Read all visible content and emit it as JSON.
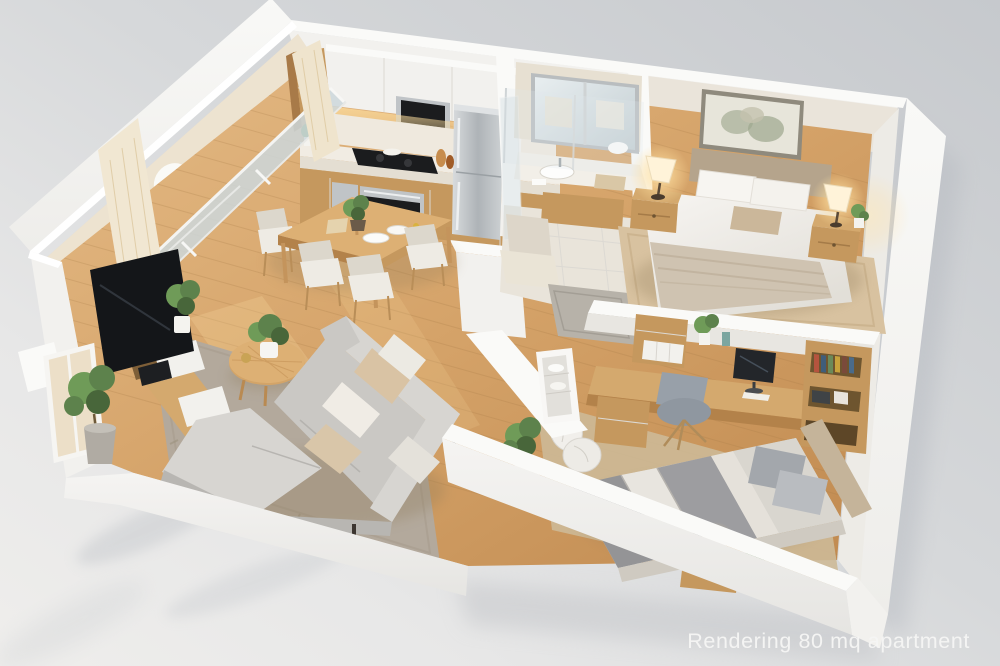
{
  "caption": "Rendering 80 mq apartment",
  "scene": {
    "type": "3D isometric cutaway rendering of an apartment",
    "area_label": "80 mq",
    "background_color": "#d3d5d8",
    "caption_color": "#f6f6f5",
    "rooms": [
      {
        "name": "balcony",
        "items": [
          "lounge chair",
          "potted plants",
          "sliding glass doors",
          "cream curtains"
        ]
      },
      {
        "name": "kitchen",
        "items": [
          "white upper cabinets",
          "built-in microwave",
          "oak base cabinets",
          "black cooktop",
          "built-in oven",
          "stainless steel refrigerator",
          "under-cabinet lighting",
          "tall oak cabinet"
        ]
      },
      {
        "name": "dining area",
        "items": [
          "oak dining table",
          "four cream chairs",
          "plant centerpiece",
          "white plates"
        ]
      },
      {
        "name": "living room",
        "items": [
          "gray L-shaped sectional sofa",
          "beige and white cushions",
          "round oak coffee table",
          "gray area rug",
          "flat-screen TV",
          "oak media console with white drawers",
          "floor plants",
          "window wall"
        ]
      },
      {
        "name": "bathroom",
        "items": [
          "vanity with sink",
          "large framed mirror",
          "glass shower partition",
          "beige tile floor",
          "wood vanity cabinet"
        ]
      },
      {
        "name": "hallway",
        "items": [
          "gray runner rug",
          "cream door mat",
          "shelf niche with towels"
        ]
      },
      {
        "name": "master bedroom",
        "items": [
          "double bed with white duvet",
          "beige throw blanket",
          "upholstered headboard",
          "framed wall art",
          "two oak nightstands",
          "two lit table lamps",
          "small plant",
          "beige rug"
        ]
      },
      {
        "name": "second bedroom",
        "items": [
          "single bed with gray striped bedding",
          "gray pillows",
          "oak desk",
          "desk organizer hutch",
          "computer monitor",
          "gray desk chair",
          "oak bookshelf with books",
          "oak nightstand",
          "white table lamp",
          "laundry bags",
          "potted plant"
        ]
      }
    ],
    "palette": {
      "walls": "#f5f4f1",
      "wood": "#c99a60",
      "floor_light": "#e3b886",
      "sofa_gray": "#d2d0cc",
      "warm_light": "#ffdf9e",
      "background": "#d3d5d8"
    }
  }
}
